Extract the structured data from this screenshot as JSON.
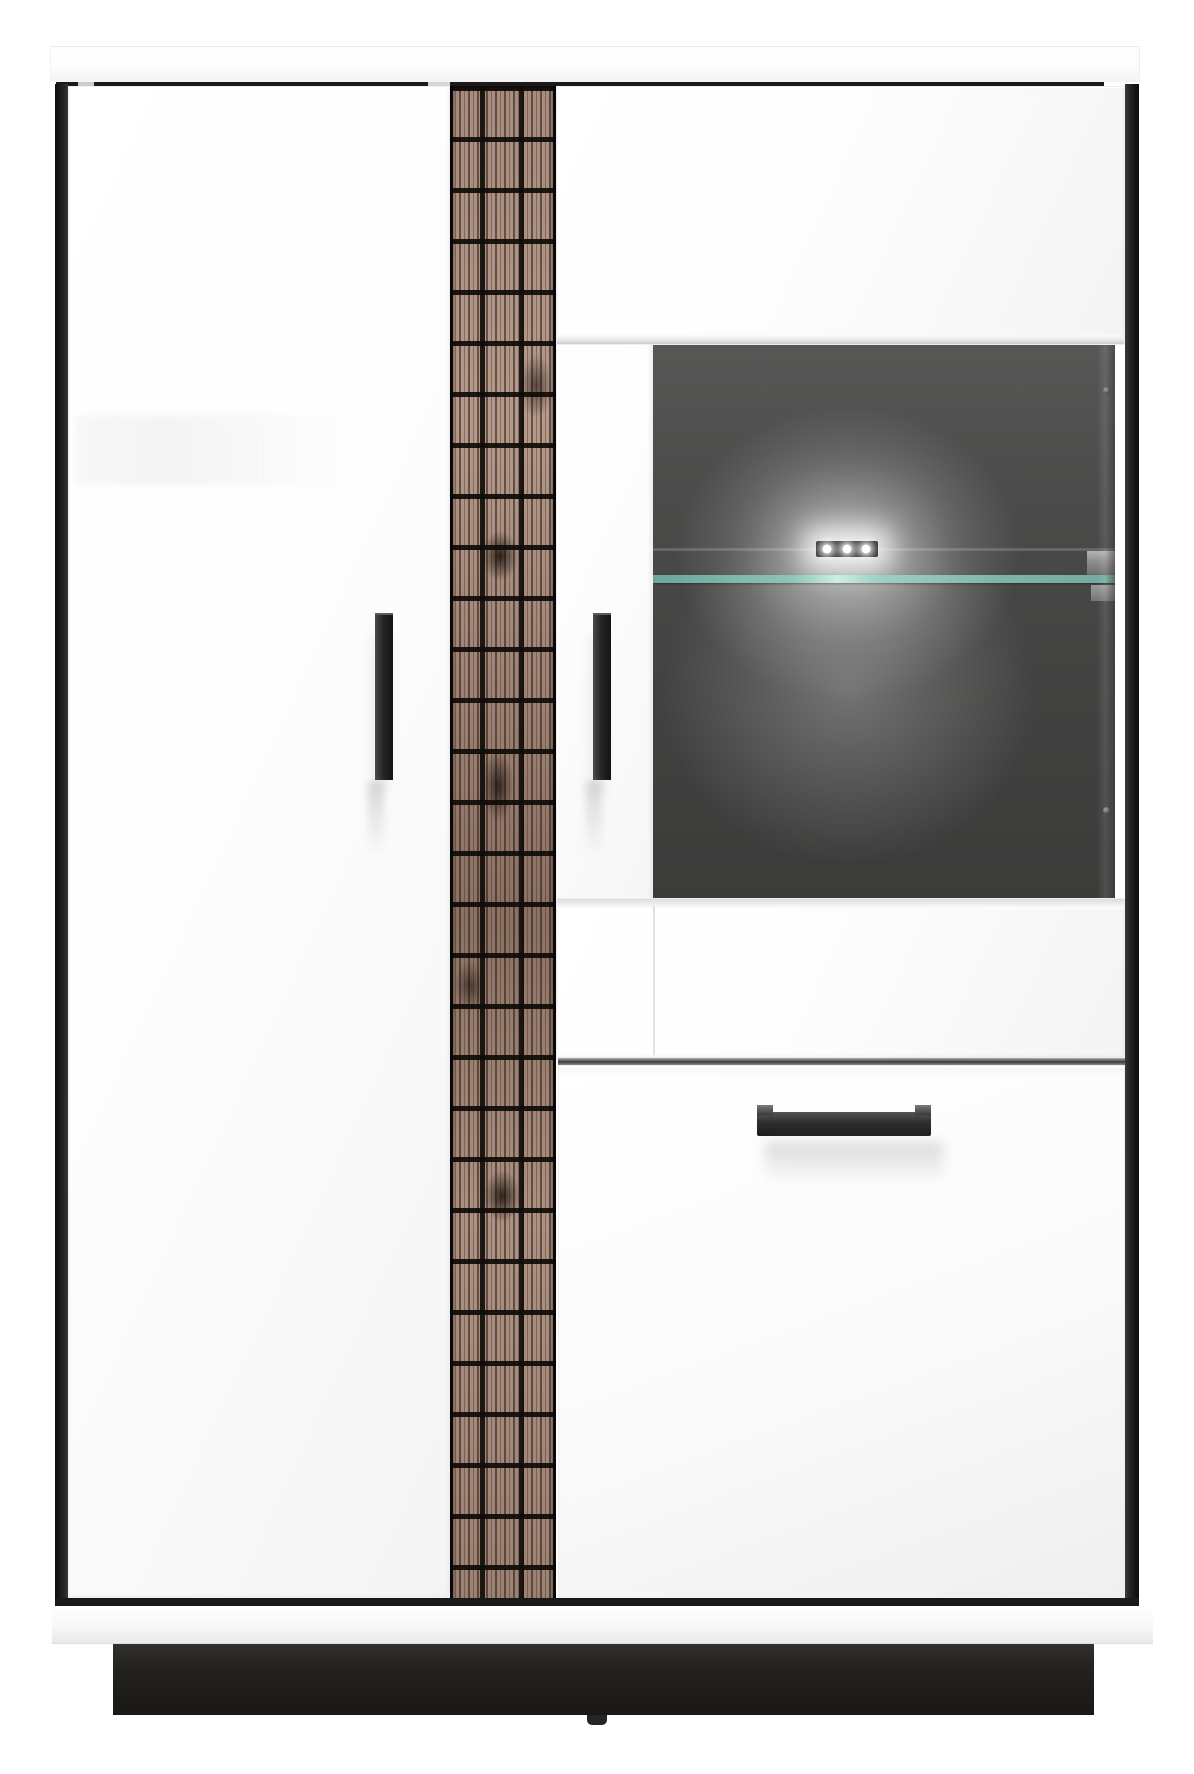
{
  "scene": {
    "kind": "furniture product photo",
    "background_color": "#ffffff"
  },
  "cabinet": {
    "body_color": "#ffffff",
    "edge_color": "#1b1b1b",
    "plinth_color": "#242220",
    "glass_interior_color": "#454544",
    "glass_shelf_edge_color": "#9fd2c5",
    "wood_accent": {
      "base_color": "#a18677",
      "grain_color": "#2b1e16",
      "grid_color": "#0f0b08",
      "pattern": "mosaic grid over pine grain"
    },
    "handles": {
      "color": "#2e2e2e",
      "vertical_count": 2,
      "horizontal_count": 1
    },
    "led": {
      "count": 3,
      "color": "#ffffff",
      "state": "on"
    }
  },
  "labels": {
    "cabinet": "display highboard cabinet",
    "top_panel": "white top panel",
    "left_side": "black left side edge",
    "right_side": "black right side edge",
    "left_door": "white left door",
    "wood_strip": "wood mosaic accent strip",
    "glass_left_frame": "glass door left frame",
    "glass_top_frame": "glass door upper panel",
    "glass_bottom_frame": "glass door lower panel",
    "glass_window": "smoked glass display window",
    "glass_shelf": "glass shelf",
    "shelf_bracket": "shelf bracket",
    "led_light": "LED spotlight bar",
    "handle_left": "left door handle",
    "handle_mid": "glass door handle",
    "drawer": "drawer front",
    "drawer_handle": "drawer handle",
    "base_rail": "white base rail",
    "plinth": "black plinth",
    "foot": "center foot"
  }
}
